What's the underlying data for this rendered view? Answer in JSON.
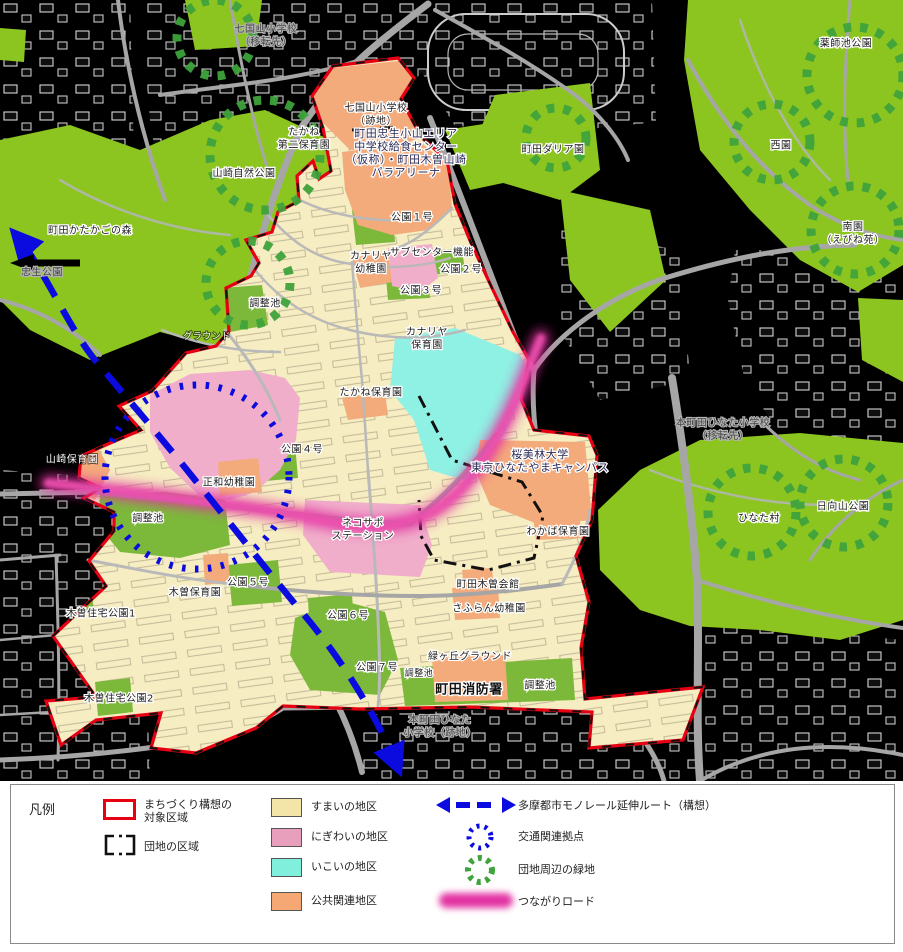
{
  "map": {
    "colors": {
      "background": "#000000",
      "residential": "#F6EDC2",
      "lively": "#F0AECA",
      "relax": "#8FF0E4",
      "public": "#F4AB7B",
      "park_outer": "#8CC51F",
      "park_inner": "#7CB93B",
      "boundary_red": "#E60012",
      "district_black": "#111111",
      "monorail_blue": "#0B0BE0",
      "green_circle": "#3FA33C",
      "tsunagari_pink": "#E233A2",
      "road": "#A6A6A6"
    },
    "labels": [
      {
        "id": "shichikokuyama-iten",
        "text": "七国山小学校\n（移転先）",
        "x": 266,
        "y": 36,
        "style": "subtle"
      },
      {
        "id": "shichikokuyama-ato",
        "text": "七国山小学校\n（跡地）",
        "x": 376,
        "y": 115,
        "style": "dark"
      },
      {
        "id": "yamazaki-shizen-koen",
        "text": "山崎自然公園",
        "x": 244,
        "y": 174,
        "style": "dark"
      },
      {
        "id": "machida-katakago-no-mori",
        "text": "町田かたかごの森",
        "x": 90,
        "y": 231,
        "style": "dark"
      },
      {
        "id": "tadao-koen",
        "text": "忠生公園",
        "x": 42,
        "y": 273,
        "style": "subtle"
      },
      {
        "id": "chosei-ike-north",
        "text": "調整池",
        "x": 265,
        "y": 304,
        "style": "dark"
      },
      {
        "id": "machida-dahlia-en",
        "text": "町田ダリア園",
        "x": 553,
        "y": 150,
        "style": "dark"
      },
      {
        "id": "yakushiike-koen",
        "text": "薬師池公園",
        "x": 846,
        "y": 44,
        "style": "dark"
      },
      {
        "id": "nishien",
        "text": "西園",
        "x": 781,
        "y": 146,
        "style": "dark"
      },
      {
        "id": "nanen-ebineen",
        "text": "南園\n（えびね苑）",
        "x": 853,
        "y": 234,
        "style": "dark"
      },
      {
        "id": "kyushoku-center",
        "text": "町田忠生小山エリア\n中学校給食センター\n（仮称）・町田木曽山崎\nパラアリーナ",
        "x": 406,
        "y": 153,
        "style": "navy"
      },
      {
        "id": "takane-daini-hoikuen",
        "text": "たかね\n第二保育園",
        "x": 304,
        "y": 139,
        "style": "dark"
      },
      {
        "id": "koen-1",
        "text": "公園１号",
        "x": 412,
        "y": 218,
        "style": "dark"
      },
      {
        "id": "subcenter-kino",
        "text": "サブセンター機能",
        "x": 432,
        "y": 253,
        "style": "dark"
      },
      {
        "id": "kanariya-yochien",
        "text": "カナリヤ\n幼稚園",
        "x": 371,
        "y": 263,
        "style": "dark"
      },
      {
        "id": "koen-2",
        "text": "公園２号",
        "x": 461,
        "y": 270,
        "style": "dark"
      },
      {
        "id": "koen-3",
        "text": "公園３号",
        "x": 421,
        "y": 291,
        "style": "dark"
      },
      {
        "id": "kanariya-hoikuen",
        "text": "カナリヤ\n保育園",
        "x": 427,
        "y": 339,
        "style": "dark"
      },
      {
        "id": "takane-hoikuen",
        "text": "たかね保育園",
        "x": 371,
        "y": 393,
        "style": "dark"
      },
      {
        "id": "ground",
        "text": "グラウンド",
        "x": 207,
        "y": 337,
        "style": "white small"
      },
      {
        "id": "koen-4",
        "text": "公園４号",
        "x": 302,
        "y": 450,
        "style": "dark"
      },
      {
        "id": "yamazaki-hoikuen",
        "text": "山崎保育園",
        "x": 72,
        "y": 460,
        "style": "white"
      },
      {
        "id": "seiwa-yochien",
        "text": "正和幼稚園",
        "x": 229,
        "y": 483,
        "style": "dark"
      },
      {
        "id": "chosei-ike-center",
        "text": "調整池",
        "x": 148,
        "y": 519,
        "style": "dark"
      },
      {
        "id": "obirin-univ",
        "text": "桜美林大学\n東京ひなたやまキャンパス",
        "x": 540,
        "y": 461,
        "style": "navy"
      },
      {
        "id": "nekosapo-station",
        "text": "ネコサポ\nステーション",
        "x": 363,
        "y": 530,
        "style": "dark"
      },
      {
        "id": "wakaba-hoikuen",
        "text": "わかば保育園",
        "x": 558,
        "y": 532,
        "style": "dark"
      },
      {
        "id": "hinatamura",
        "text": "ひなた村",
        "x": 759,
        "y": 519,
        "style": "dark"
      },
      {
        "id": "hinatayama-koen",
        "text": "日向山公園",
        "x": 843,
        "y": 507,
        "style": "dark"
      },
      {
        "id": "honmachida-hinata-iten",
        "text": "本町田ひなた小学校\n（移転先）",
        "x": 723,
        "y": 430,
        "style": "subtle"
      },
      {
        "id": "kiso-hoikuen",
        "text": "木曽保育園",
        "x": 195,
        "y": 593,
        "style": "dark"
      },
      {
        "id": "koen-5",
        "text": "公園５号",
        "x": 248,
        "y": 583,
        "style": "dark"
      },
      {
        "id": "kiso-jutaku-koen-1",
        "text": "木曽住宅公園1",
        "x": 101,
        "y": 614,
        "style": "dark"
      },
      {
        "id": "kiso-jutaku-koen-2",
        "text": "木曽住宅公園2",
        "x": 119,
        "y": 699,
        "style": "dark"
      },
      {
        "id": "koen-6",
        "text": "公園６号",
        "x": 348,
        "y": 616,
        "style": "dark"
      },
      {
        "id": "machida-kiso-kaikan",
        "text": "町田木曽会館",
        "x": 488,
        "y": 585,
        "style": "dark"
      },
      {
        "id": "safuran-yochien",
        "text": "さふらん幼稚園",
        "x": 489,
        "y": 609,
        "style": "dark"
      },
      {
        "id": "koen-7",
        "text": "公園７号",
        "x": 377,
        "y": 668,
        "style": "dark"
      },
      {
        "id": "chosei-ike-small",
        "text": "調整池",
        "x": 419,
        "y": 674,
        "style": "dark small"
      },
      {
        "id": "midorigaoka-ground",
        "text": "緑ヶ丘グラウンド",
        "x": 470,
        "y": 657,
        "style": "dark"
      },
      {
        "id": "machida-shobosho",
        "text": "町田消防署",
        "x": 469,
        "y": 690,
        "style": "fire"
      },
      {
        "id": "chosei-ike-east",
        "text": "調整池",
        "x": 540,
        "y": 686,
        "style": "dark"
      },
      {
        "id": "honmachida-hinata-ato",
        "text": "本町田ひなた\n小学校（跡地）",
        "x": 440,
        "y": 727,
        "style": "subtle"
      }
    ]
  },
  "legend": {
    "title": "凡例",
    "items": [
      {
        "id": "target-area",
        "label": "まちづくり構想の\n対象区域"
      },
      {
        "id": "danchi-area",
        "label": "団地の区域"
      },
      {
        "id": "sumai",
        "label": "すまいの地区",
        "color": "#F3E4A8"
      },
      {
        "id": "nigiwai",
        "label": "にぎわいの地区",
        "color": "#E79FBB"
      },
      {
        "id": "ikoi",
        "label": "いこいの地区",
        "color": "#80F0DC"
      },
      {
        "id": "kokyo",
        "label": "公共関連地区",
        "color": "#F5A873"
      },
      {
        "id": "monorail",
        "label": "多摩都市モノレール延伸ルート（構想）"
      },
      {
        "id": "hub",
        "label": "交通関連拠点"
      },
      {
        "id": "greenery",
        "label": "団地周辺の緑地"
      },
      {
        "id": "tsunagari",
        "label": "つながりロード"
      }
    ]
  }
}
